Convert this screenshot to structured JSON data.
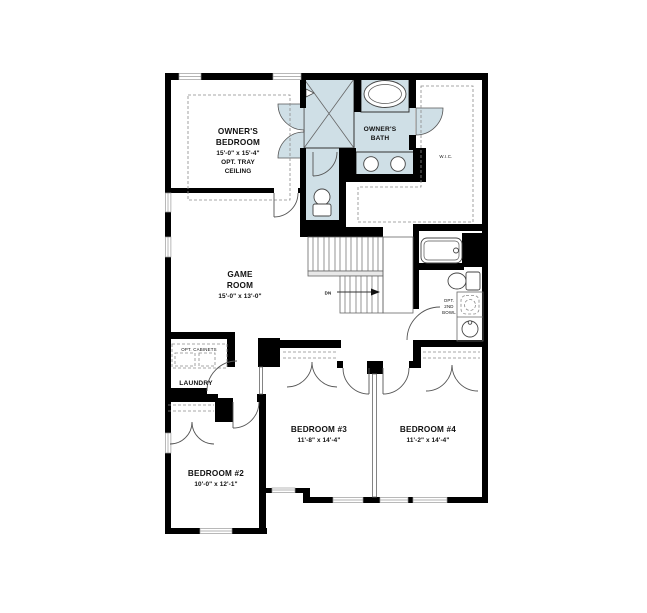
{
  "title": "Second Floor Plan",
  "colors": {
    "wall": "#000000",
    "wet_area": "#cfdfe6",
    "background": "#ffffff"
  },
  "rooms": {
    "owners_bedroom": {
      "name_line1": "OWNER'S",
      "name_line2": "BEDROOM",
      "dims": "15'-0\" x 15'-4\"",
      "note_line1": "OPT. TRAY",
      "note_line2": "CEILING"
    },
    "owners_bath": {
      "name_line1": "OWNER'S",
      "name_line2": "BATH"
    },
    "wic": {
      "name": "W.I.C."
    },
    "game_room": {
      "name_line1": "GAME",
      "name_line2": "ROOM",
      "dims": "15'-0\" x 13'-0\""
    },
    "laundry": {
      "name": "LAUNDRY",
      "note": "OPT. CABINETS"
    },
    "bedroom2": {
      "name": "BEDROOM #2",
      "dims": "10'-0\" x 12'-1\""
    },
    "bedroom3": {
      "name": "BEDROOM #3",
      "dims": "11'-8\" x 14'-4\""
    },
    "bedroom4": {
      "name": "BEDROOM #4",
      "dims": "11'-2\" x 14'-4\""
    }
  },
  "annotations": {
    "stairs_down": "DN",
    "opt_bowl_line1": "OPT.",
    "opt_bowl_line2": "2ND",
    "opt_bowl_line3": "BOWL"
  },
  "fixtures": {
    "owners_bath": [
      "shower",
      "soaking-tub",
      "double-sink-vanity",
      "toilet"
    ],
    "hall_bath": [
      "tub",
      "toilet",
      "vanity-sink",
      "optional-second-bowl"
    ],
    "stairs": "stairs-down"
  }
}
